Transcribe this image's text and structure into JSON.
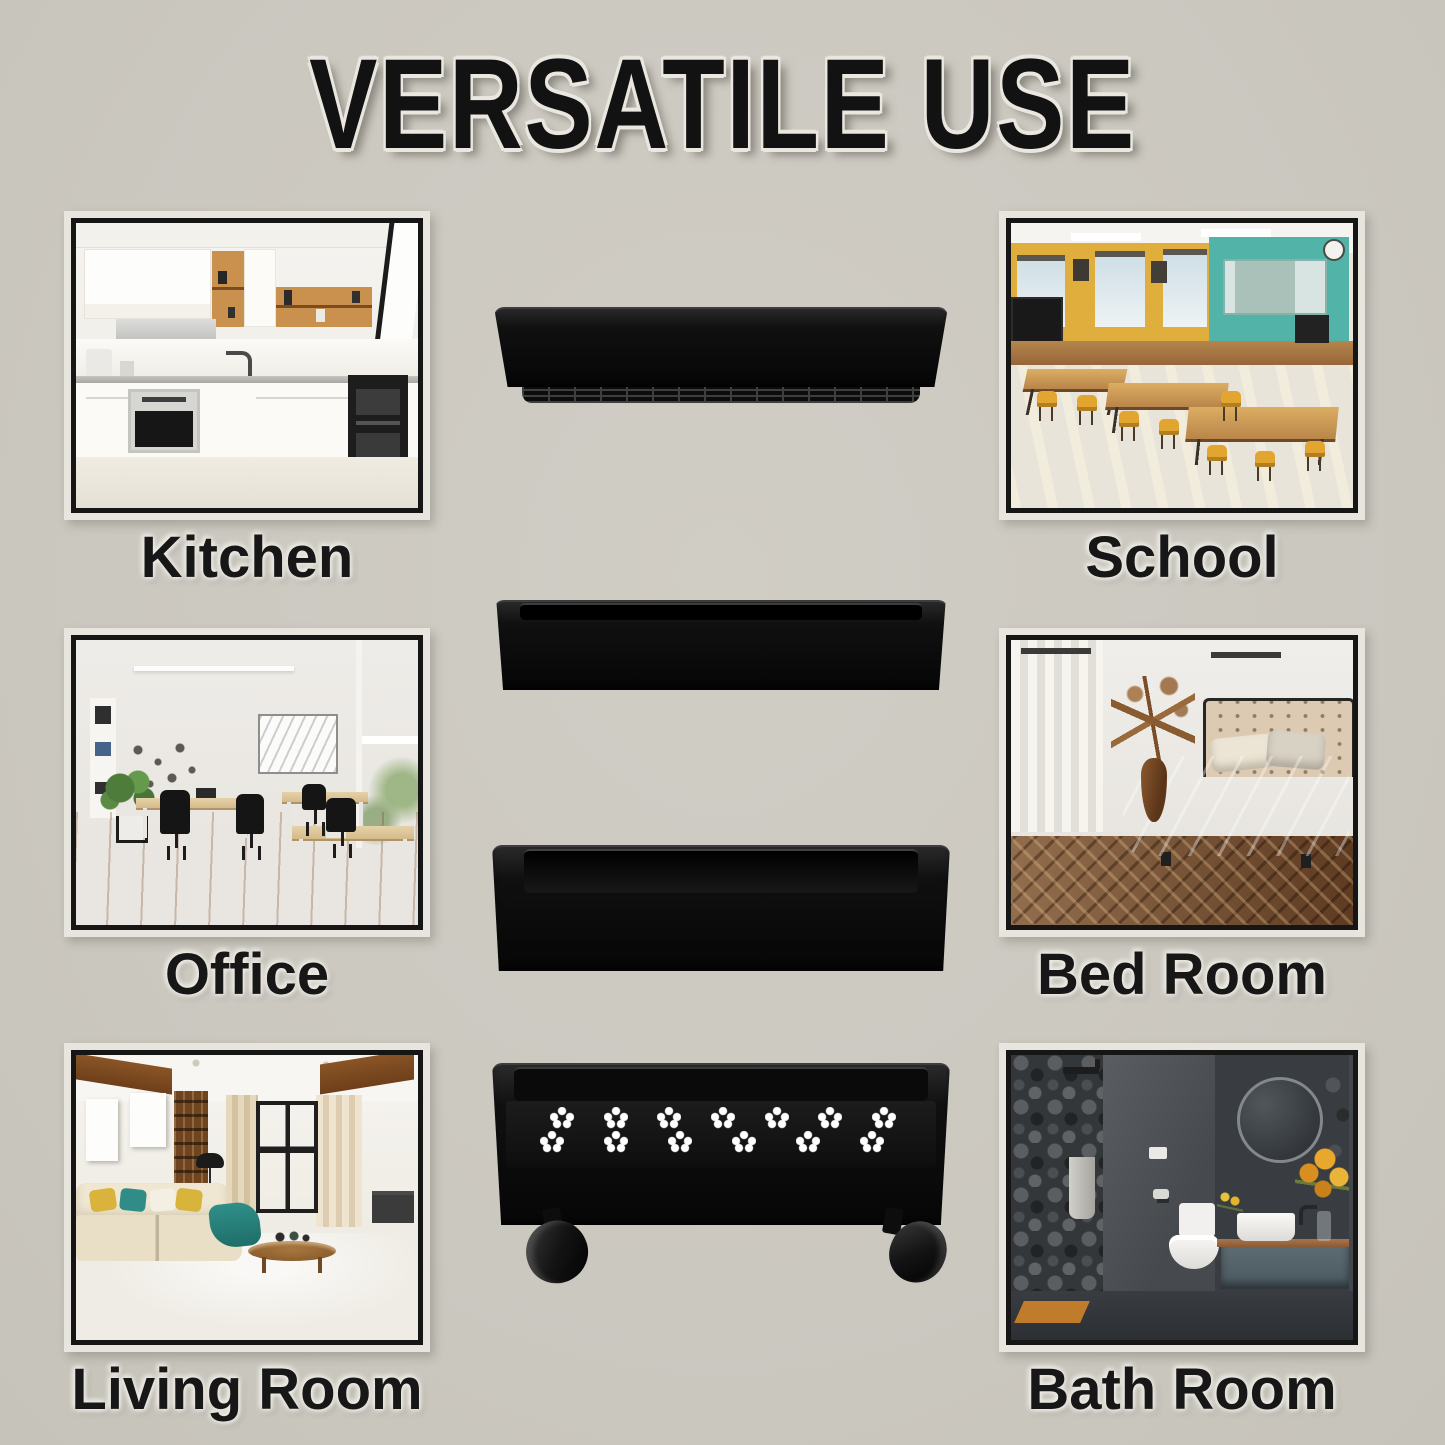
{
  "title": "VERSATILE USE",
  "rooms": {
    "kitchen": {
      "label": "Kitchen"
    },
    "school": {
      "label": "School"
    },
    "office": {
      "label": "Office"
    },
    "bedroom": {
      "label": "Bed Room"
    },
    "living_room": {
      "label": "Living Room"
    },
    "bathroom": {
      "label": "Bath Room"
    }
  },
  "product": {
    "icon": "4-tier-black-slim-rolling-storage-cart",
    "tiers": 4,
    "perforation_shape": "flower",
    "perforation_rows": [
      7,
      6
    ]
  },
  "colors": {
    "background": "#cbc8c0",
    "title_text": "#121212",
    "label_text": "#171717",
    "frame_border": "#161616",
    "frame_mat": "#e7e5de",
    "cart_body": "#101010",
    "chrome_pole": "#d6d6d6",
    "perforation": "#ffffff"
  }
}
